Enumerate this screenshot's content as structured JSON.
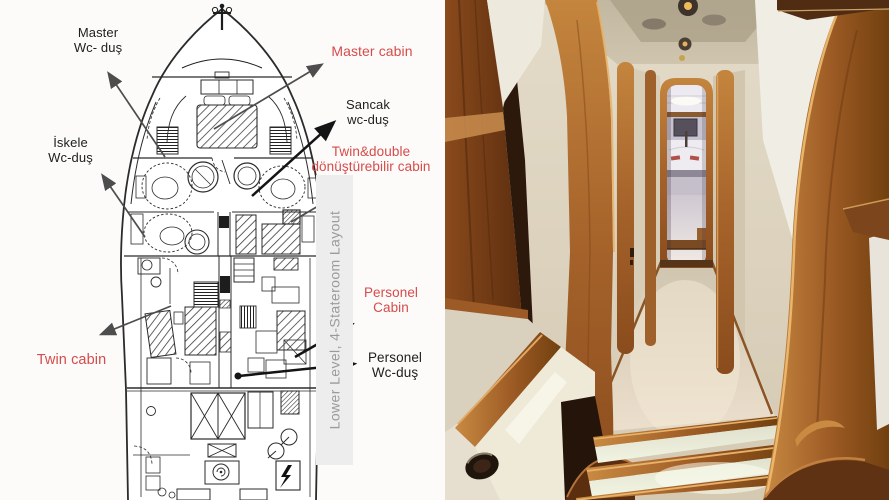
{
  "panels": {
    "floorplan": {
      "labels": {
        "master_wc": {
          "line1": "Master",
          "line2": "Wc- duş"
        },
        "master_cabin": {
          "line1": "Master cabin"
        },
        "sancak_wc": {
          "line1": "Sancak",
          "line2": "wc-duş"
        },
        "iskele_wc": {
          "line1": "İskele",
          "line2": "Wc-duş"
        },
        "twin_double": {
          "line1": "Twin&double",
          "line2": "dönüştürebilir cabin"
        },
        "twin_cabin": {
          "line1": "Twin cabin"
        },
        "personel_cabin": {
          "line1": "Personel",
          "line2": "Cabin"
        },
        "personel_wc": {
          "line1": "Personel",
          "line2": "Wc-duş"
        }
      },
      "watermark": "Lower Level, 4-Stateroom Layout"
    },
    "photo": {}
  },
  "palette": {
    "label_red": "#d64b4b",
    "label_black": "#1e1e1e",
    "watermark_gray": "#9b9b9b",
    "watermark_band": "#ededed",
    "arrow_gray": "#4d4d4d",
    "arrow_black": "#141414",
    "plan_line": "#2b2b2b",
    "wood_light": "#c98a46",
    "wood_mid": "#a5622a",
    "wood_dark": "#6e3a12",
    "wall_cream": "#ded4c1",
    "wall_bright": "#f0ede4",
    "carpet_beige": "#dcd2bf",
    "ceiling_taupe": "#bdb29b"
  }
}
